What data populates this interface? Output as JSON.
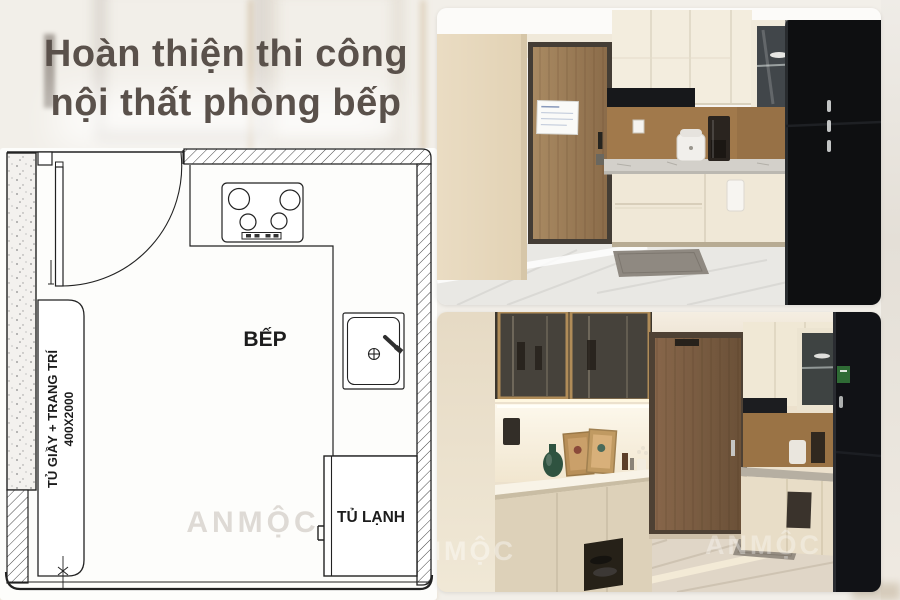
{
  "header": {
    "title_line1": "Hoàn thiện thi công",
    "title_line2": "nội thất phòng bếp"
  },
  "floor_plan": {
    "room_label": "BẾP",
    "fridge_label": "TỦ LẠNH",
    "cabinet_label": "TỦ GIẦY + TRANG TRÍ",
    "cabinet_dimension": "400X2000",
    "watermark": "ANMỘC"
  },
  "photos": {
    "bottom": {
      "watermark_left": "ANMỘC",
      "watermark_right": "ANMỘC"
    }
  },
  "colors": {
    "background": "#f2efe9",
    "title_text": "#5a514b",
    "plan_line": "#222222",
    "plan_watermark": "#d9d5cf",
    "cabinet_cream": "#f1ead9",
    "wood_door": "#9b7c5a",
    "backsplash_brown": "#a1794b",
    "appliance_black": "#0e0f11"
  }
}
